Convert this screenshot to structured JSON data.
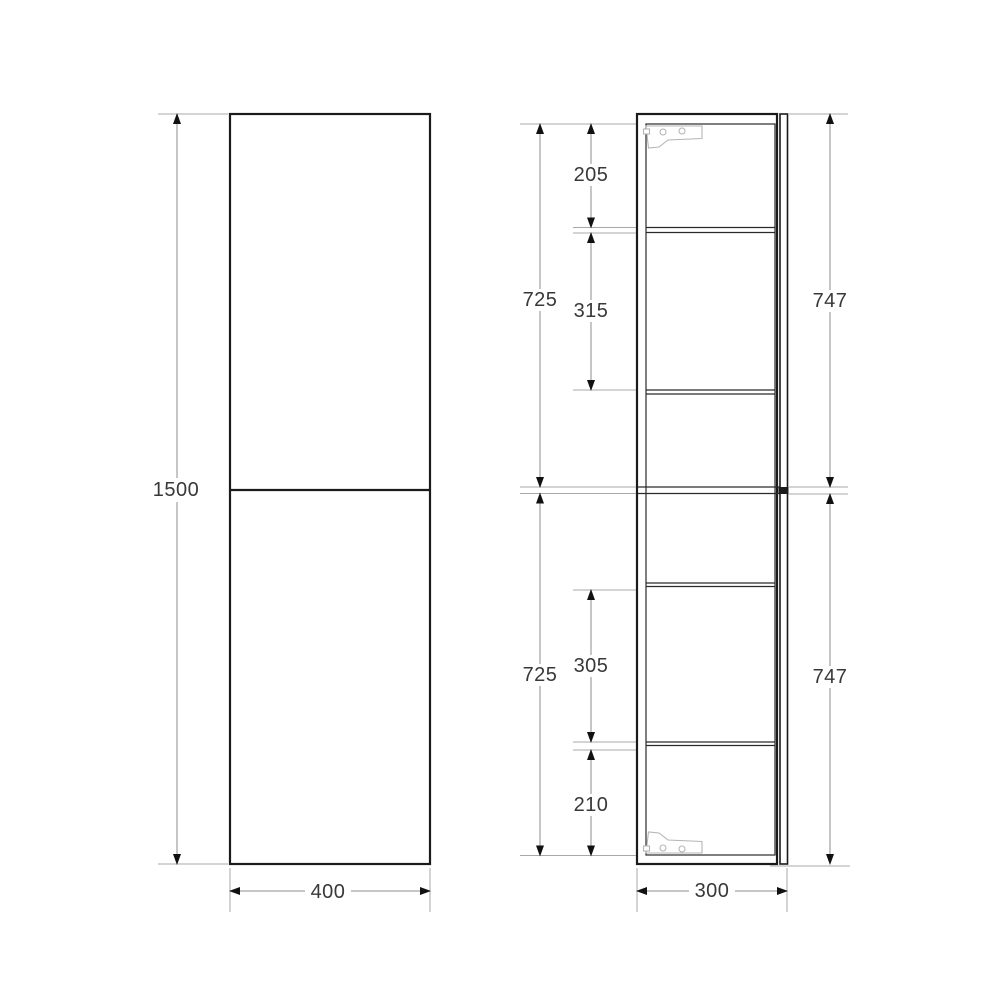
{
  "views": {
    "front": {
      "overall_height": "1500",
      "overall_width": "400"
    },
    "side": {
      "overall_depth": "300",
      "upper_left_total": "725",
      "lower_left_total": "725",
      "upper_right_total": "747",
      "lower_right_total": "747",
      "compartment_1": "205",
      "compartment_2": "315",
      "compartment_3": "305",
      "compartment_4": "210"
    }
  },
  "colors": {
    "outline": "#1b1b1b",
    "thin_line": "#2a2a2a",
    "extension_line": "#a8a8a8",
    "dimension_line": "#8c8c8c",
    "bracket_icon": "#b5b5b5",
    "label_text": "#383838",
    "background": "#ffffff"
  }
}
